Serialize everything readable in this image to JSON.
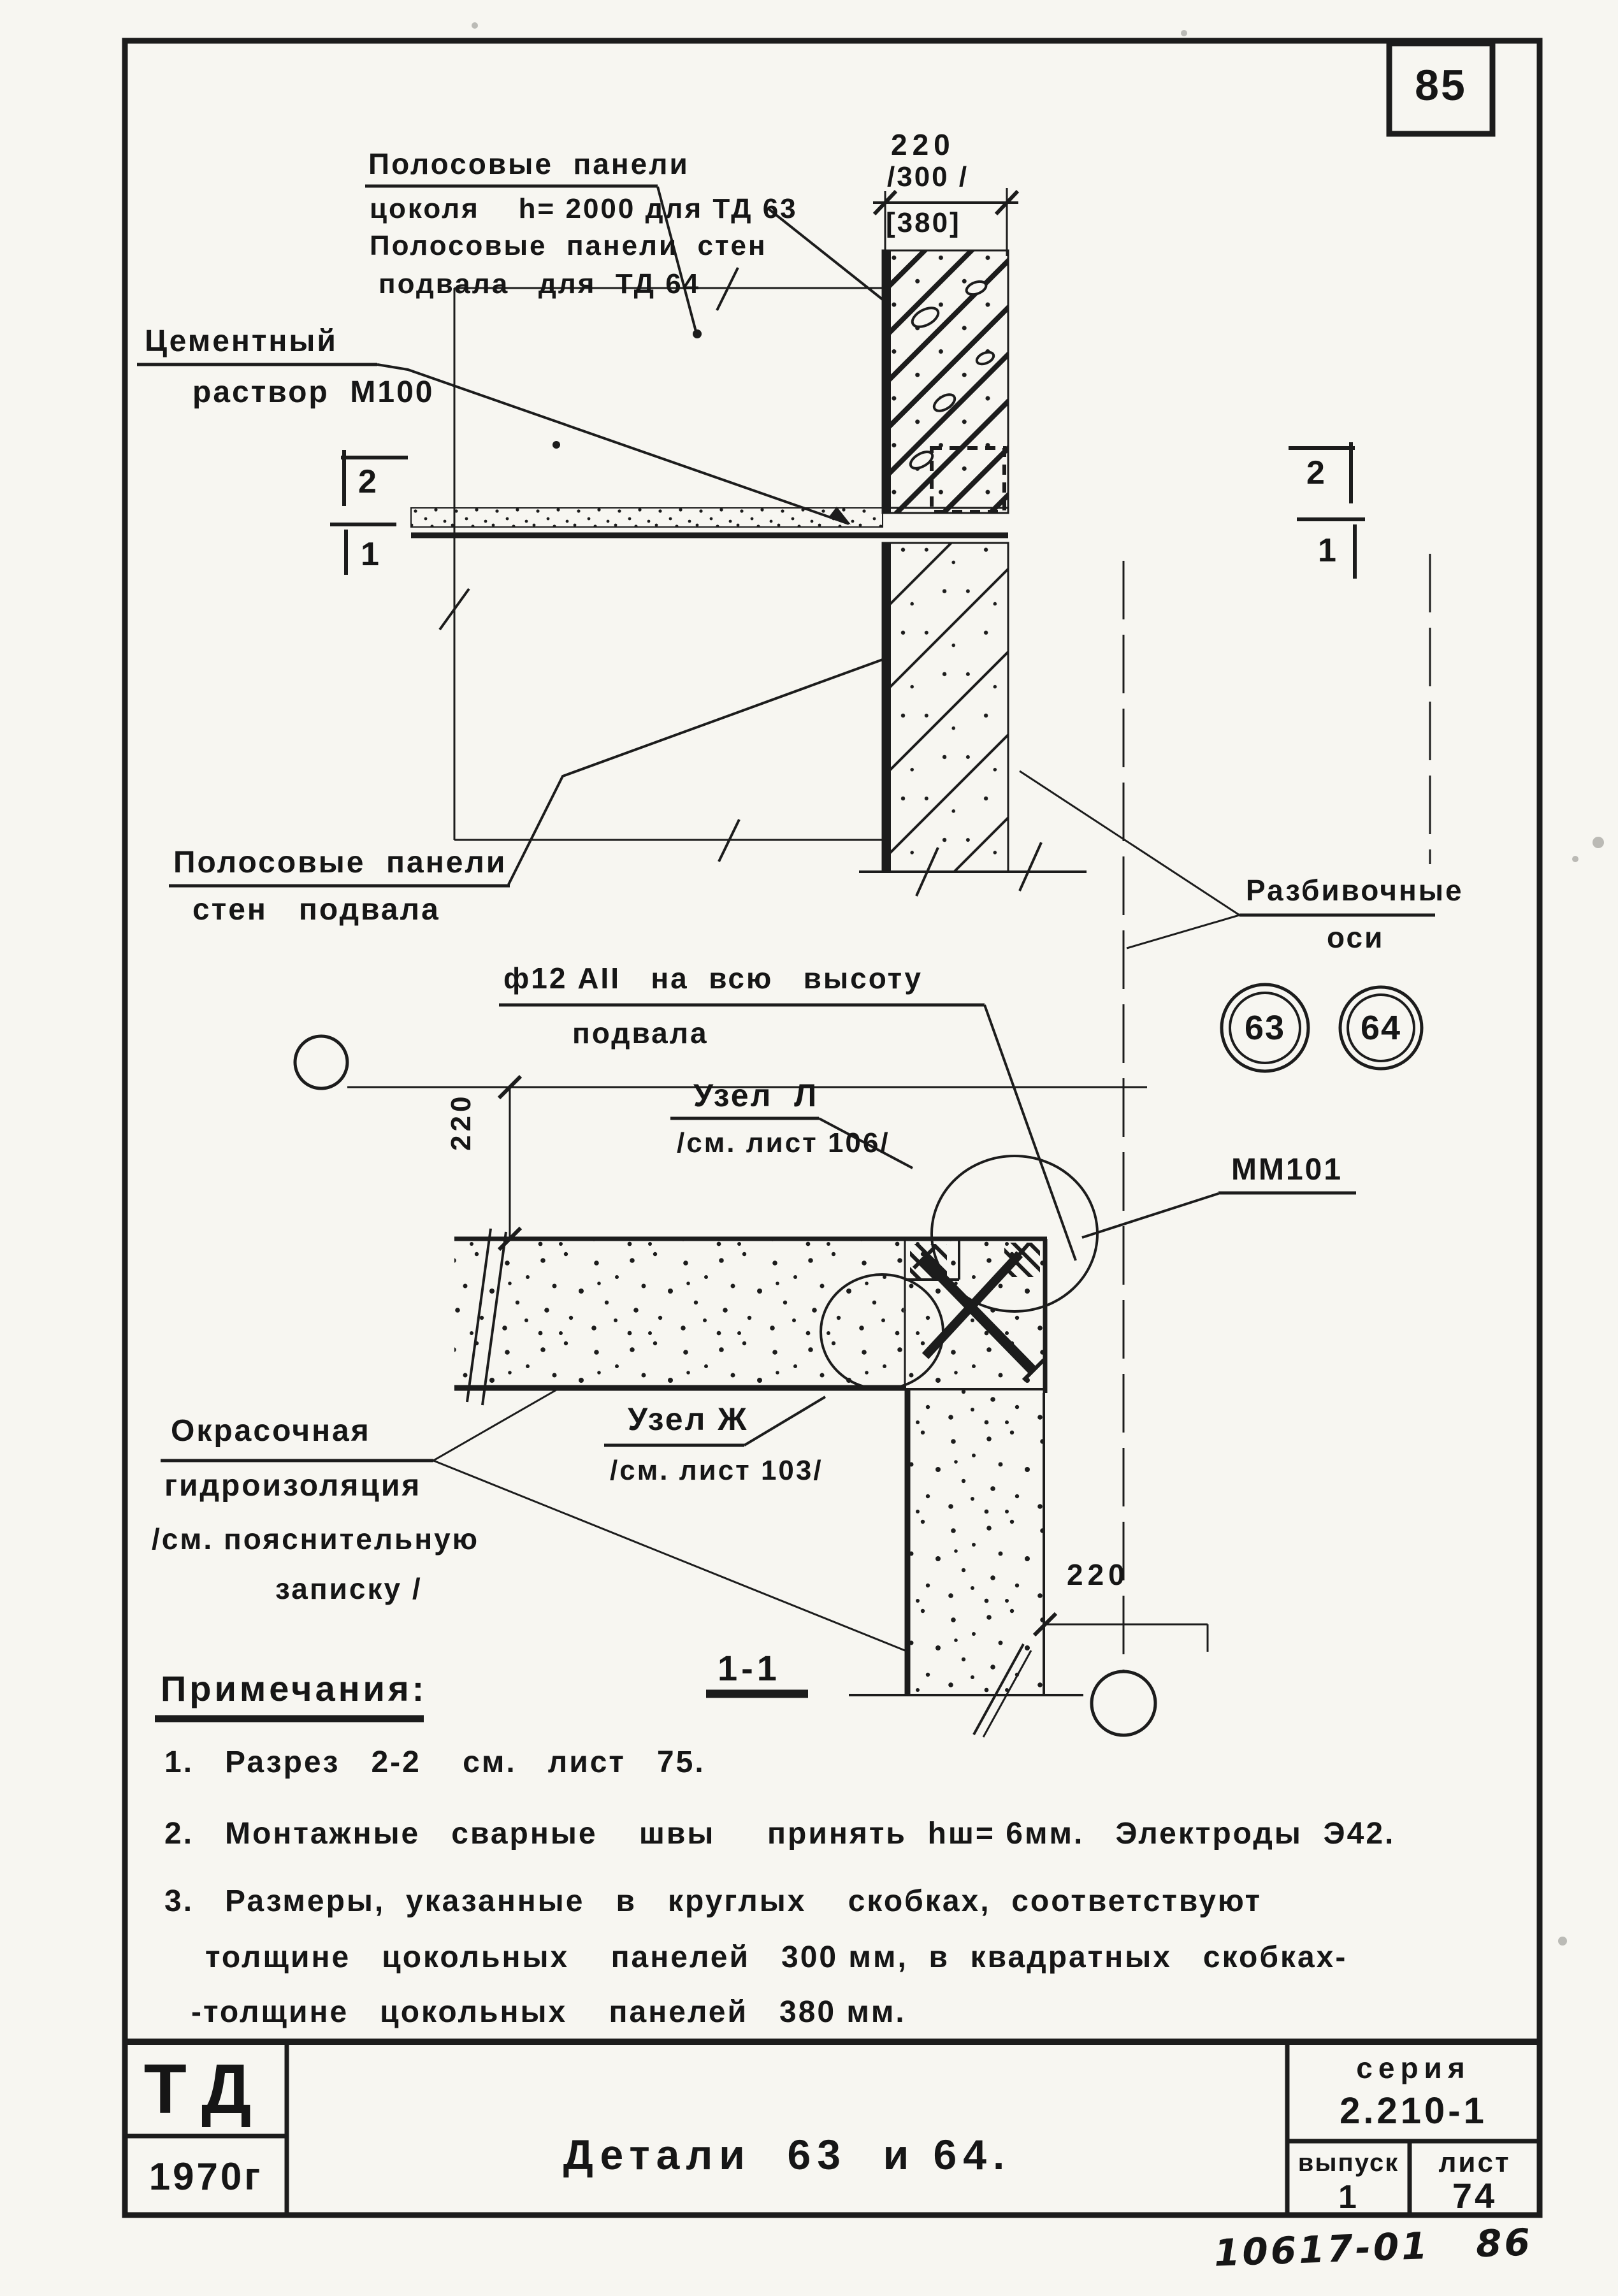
{
  "sheet": {
    "page_number": "85",
    "handwritten_code": "10617-01   86"
  },
  "section_view": {
    "panel_label_1": "Полосовые  панели",
    "panel_label_2": "цоколя    h= 2000 для ТД 63",
    "panel_label_3": "Полосовые  панели  стен",
    "panel_label_4": "подвала   для  ТД 64",
    "mortar_label_1": "Цементный",
    "mortar_label_2": "раствор  М100",
    "dim_220": "220",
    "dim_300": "/300 /",
    "dim_380": "[380]",
    "mark_left_top": "2",
    "mark_left_bottom": "1",
    "mark_right_top": "2",
    "mark_right_bottom": "1",
    "wall_label_1": "Полосовые  панели",
    "wall_label_2": "стен   подвала"
  },
  "plan_view": {
    "axes_label_1": "Разбивочные",
    "axes_label_2": "оси",
    "axis_63": "63",
    "axis_64": "64",
    "rebar_label_1": "ф12 АII   на  всю   высоту",
    "rebar_label_2": "подвала",
    "node_l_title": "Узел  Л",
    "node_l_ref": "/см. лист 106/",
    "node_zh_title": "Узел Ж",
    "node_zh_ref": "/см. лист 103/",
    "embed_mark": "ММ101",
    "wp_label_1": "Окрасочная",
    "wp_label_2": "гидроизоляция",
    "wp_label_3": "/см. пояснительную",
    "wp_label_4": "записку /",
    "dim_left": "220",
    "dim_bottom": "220",
    "section_ref": "1-1"
  },
  "notes": {
    "heading": "Примечания:",
    "n1": "1.   Разрез   2-2    см.   лист   75.",
    "n2": "2.   Монтажные   сварные    швы     принять  hш= 6мм.   Электроды  Э42.",
    "n3a": "3.   Размеры,  указанные   в   круглых    скобках,  соответствуют",
    "n3b": "толщине   цокольных    панелей   300 мм,  в  квадратных   скобках-",
    "n3c": "-толщине   цокольных    панелей   380 мм."
  },
  "title_block": {
    "org": "ТД",
    "year": "1970г",
    "title": "Детали  63  и 64.",
    "series_label": "серия",
    "series_value": "2.210-1",
    "issue_label": "выпуск",
    "issue_value": "1",
    "sheet_label": "лист",
    "sheet_value": "74"
  }
}
